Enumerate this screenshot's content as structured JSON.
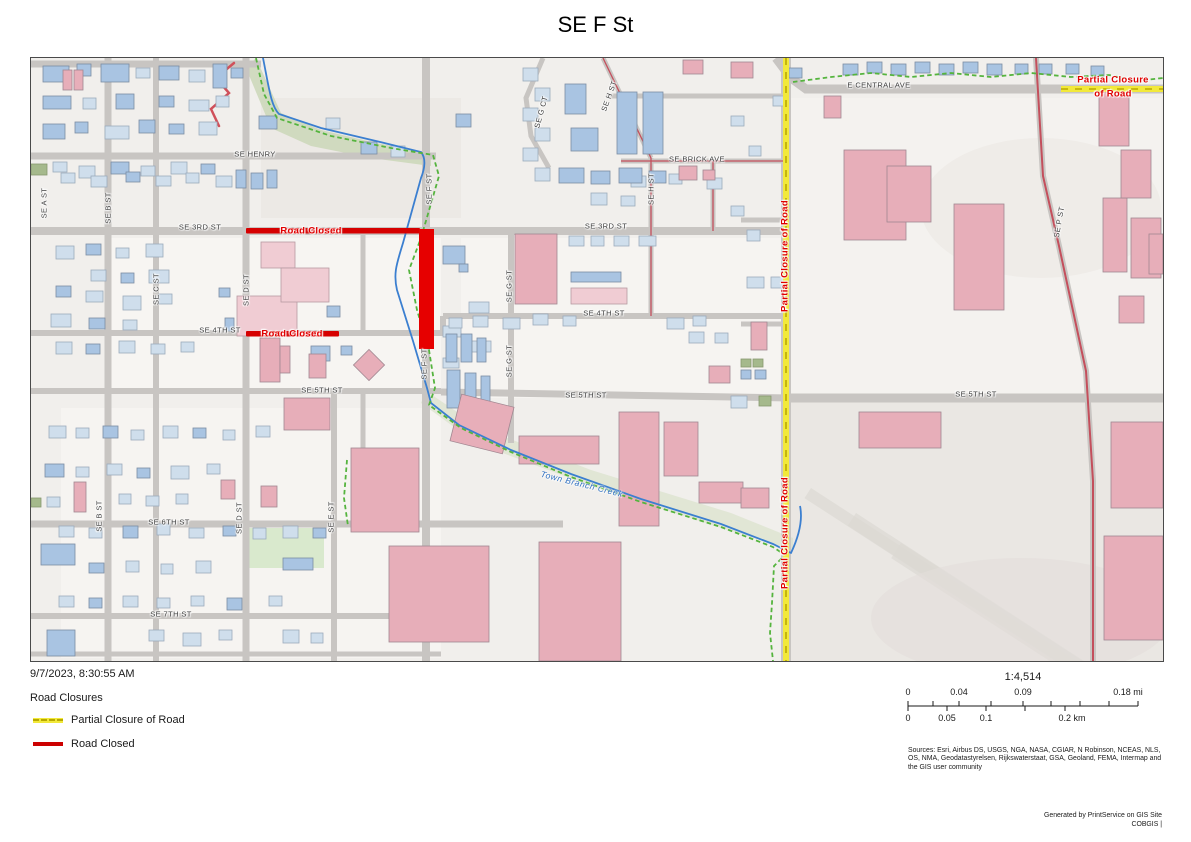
{
  "title": "SE F St",
  "map": {
    "street_labels": [
      {
        "text": "E CENTRAL AVE",
        "x": 848,
        "y": 27,
        "rot": 0
      },
      {
        "text": "SE HENRY",
        "x": 224,
        "y": 96,
        "rot": 0
      },
      {
        "text": "SE BRICK AVE",
        "x": 666,
        "y": 101,
        "rot": 0
      },
      {
        "text": "SE 3RD ST",
        "x": 169,
        "y": 169,
        "rot": 0
      },
      {
        "text": "SE 3RD ST",
        "x": 575,
        "y": 168,
        "rot": 0
      },
      {
        "text": "SE 4TH ST",
        "x": 189,
        "y": 272,
        "rot": 0
      },
      {
        "text": "SE 4TH ST",
        "x": 573,
        "y": 255,
        "rot": 0
      },
      {
        "text": "SE 5TH ST",
        "x": 291,
        "y": 332,
        "rot": 0
      },
      {
        "text": "SE 5TH ST",
        "x": 555,
        "y": 337,
        "rot": 0
      },
      {
        "text": "SE 5TH ST",
        "x": 945,
        "y": 336,
        "rot": 0
      },
      {
        "text": "SE 6TH ST",
        "x": 138,
        "y": 464,
        "rot": 0
      },
      {
        "text": "SE 7TH ST",
        "x": 140,
        "y": 556,
        "rot": 0
      },
      {
        "text": "SE A ST",
        "x": 13,
        "y": 145,
        "rot": -90
      },
      {
        "text": "SE B ST",
        "x": 77,
        "y": 150,
        "rot": -90
      },
      {
        "text": "SE C ST",
        "x": 125,
        "y": 231,
        "rot": -90
      },
      {
        "text": "SE D ST",
        "x": 215,
        "y": 232,
        "rot": -90
      },
      {
        "text": "SE F ST",
        "x": 398,
        "y": 131,
        "rot": -90
      },
      {
        "text": "SE F ST",
        "x": 393,
        "y": 306,
        "rot": -90
      },
      {
        "text": "SE G ST",
        "x": 478,
        "y": 228,
        "rot": -90
      },
      {
        "text": "SE G ST",
        "x": 478,
        "y": 303,
        "rot": -90
      },
      {
        "text": "SE H ST",
        "x": 620,
        "y": 131,
        "rot": -90
      },
      {
        "text": "SE B ST",
        "x": 68,
        "y": 458,
        "rot": -90
      },
      {
        "text": "SE D ST",
        "x": 208,
        "y": 460,
        "rot": -90
      },
      {
        "text": "SE E ST",
        "x": 300,
        "y": 459,
        "rot": -90
      },
      {
        "text": "SE P ST",
        "x": 1028,
        "y": 164,
        "rot": -80
      },
      {
        "text": "SE G CT",
        "x": 510,
        "y": 54,
        "rot": -75
      },
      {
        "text": "SE H ST",
        "x": 578,
        "y": 38,
        "rot": -70
      }
    ],
    "closure_labels": [
      {
        "text": "Road Closed",
        "x": 280,
        "y": 173,
        "rot": 0
      },
      {
        "text": "Road Closed",
        "x": 261,
        "y": 276,
        "rot": 0
      },
      {
        "text": "Partial Closure of Road",
        "x": 754,
        "y": 198,
        "rot": -90
      },
      {
        "text": "Partial Closure of Road",
        "x": 754,
        "y": 475,
        "rot": -90
      },
      {
        "text": "Partial Closure",
        "x": 1082,
        "y": 22,
        "rot": 0
      },
      {
        "text": "of Road",
        "x": 1082,
        "y": 36,
        "rot": 0
      }
    ],
    "creek_label": {
      "text": "Town Branch Creek",
      "x": 551,
      "y": 426,
      "rot": 14
    }
  },
  "footer": {
    "timestamp": "9/7/2023, 8:30:55 AM",
    "legend": {
      "heading": "Road Closures",
      "items": [
        {
          "label": "Partial Closure of Road",
          "style": "yellow-dashed",
          "color": "#f2e93a"
        },
        {
          "label": "Road Closed",
          "style": "solid",
          "color": "#cc0000"
        }
      ]
    },
    "scale": {
      "ratio": "1:4,514",
      "mi_labels": [
        "0",
        "0.04",
        "0.09",
        "0.18 mi"
      ],
      "km_labels": [
        "0",
        "0.05",
        "0.1",
        "0.2 km"
      ]
    },
    "sources": "Sources: Esri, Airbus DS, USGS, NGA, NASA, CGIAR, N Robinson, NCEAS, NLS, OS, NMA, Geodatastyrelsen, Rijkswaterstaat, GSA, Geoland, FEMA, Intermap and the GIS user community",
    "generated_line1": "Generated by PrintService on GIS Site",
    "generated_line2": "COBGIS |"
  }
}
